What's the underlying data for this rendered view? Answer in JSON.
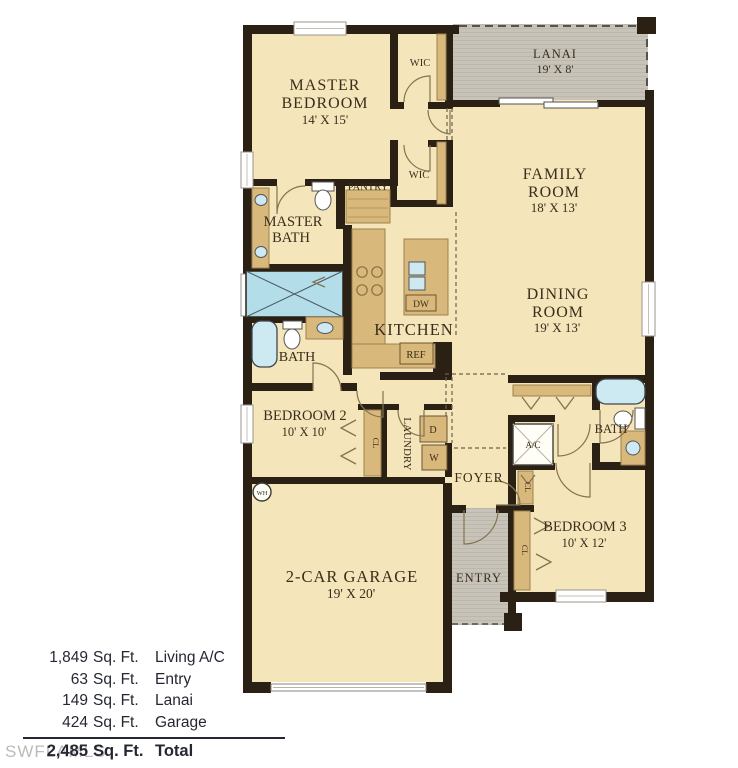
{
  "plan": {
    "lanai": {
      "name": "LANAI",
      "dims": "19' X 8'"
    },
    "master_bedroom": {
      "l1": "MASTER",
      "l2": "BEDROOM",
      "dims": "14' X 15'"
    },
    "wic_upper": "WIC",
    "wic_lower": "WIC",
    "family_room": {
      "l1": "FAMILY",
      "l2": "ROOM",
      "dims": "18' X 13'"
    },
    "dining_room": {
      "l1": "DINING",
      "l2": "ROOM",
      "dims": "19' X 13'"
    },
    "master_bath": {
      "l1": "MASTER",
      "l2": "BATH"
    },
    "pantry": "PANTRY",
    "kitchen": "KITCHEN",
    "dishwasher": "DW",
    "refrigerator": "REF",
    "hall_bath": "BATH",
    "bedroom2": {
      "name": "BEDROOM 2",
      "dims": "10' X 10'"
    },
    "laundry": "LAUNDRY",
    "dryer": "D",
    "washer": "W",
    "water_heater": "WH",
    "closet": "CL",
    "foyer": "FOYER",
    "ac": "A/C",
    "bath2": "BATH",
    "bedroom3": {
      "name": "BEDROOM 3",
      "dims": "10' X 12'"
    },
    "entry": "ENTRY",
    "garage": {
      "name": "2-CAR GARAGE",
      "dims": "19' X 20'"
    }
  },
  "areas": {
    "rows": [
      {
        "value": "1,849",
        "unit": "Sq. Ft.",
        "label": "Living A/C"
      },
      {
        "value": "63",
        "unit": "Sq. Ft.",
        "label": "Entry"
      },
      {
        "value": "149",
        "unit": "Sq. Ft.",
        "label": "Lanai"
      },
      {
        "value": "424",
        "unit": "Sq. Ft.",
        "label": "Garage"
      }
    ],
    "total": {
      "value": "2,485",
      "unit": "Sq. Ft.",
      "label": "Total"
    }
  },
  "watermark": "SWFLAMLS",
  "colors": {
    "wall": "#2b2014",
    "floor": "#f4e6ba",
    "cabinetry": "#d8b87b",
    "porch": "#c8c3b9",
    "water": "#b3dde9",
    "plan_text": "#3a2d1b",
    "summary_text": "#252833",
    "watermark": "#ababab"
  }
}
